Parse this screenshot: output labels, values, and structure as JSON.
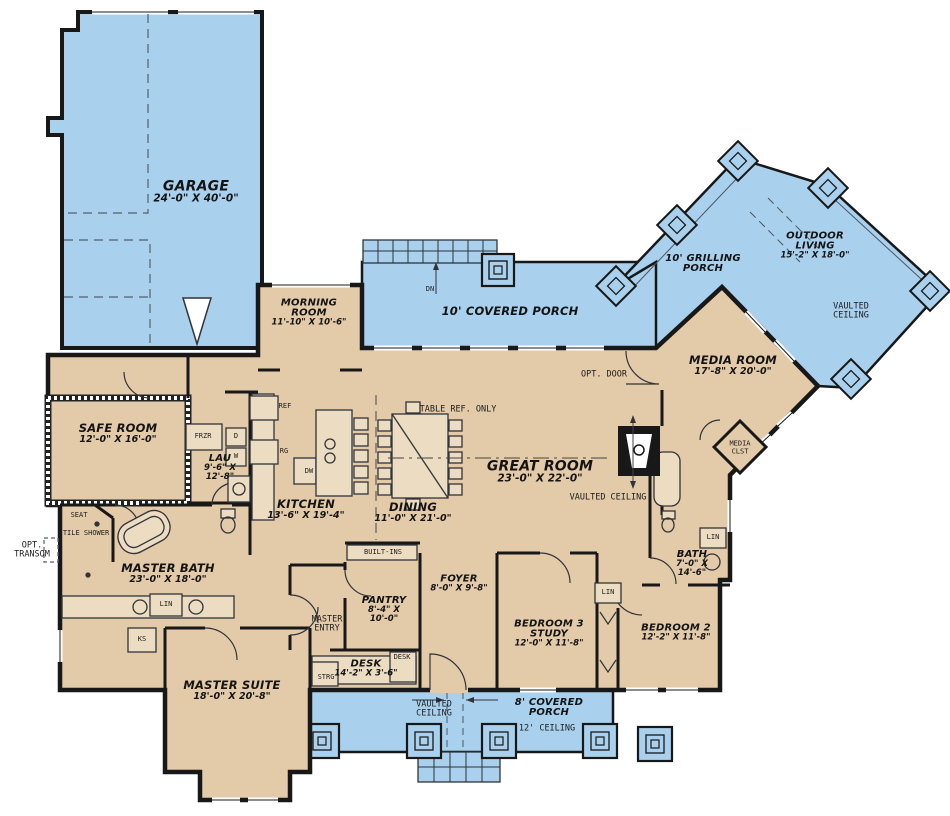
{
  "colors": {
    "porch_blue": "#a9d1ee",
    "interior_tan": "#e3caa9",
    "wall_black": "#181818",
    "thin_line": "#3c3c3c"
  },
  "rooms": {
    "garage": {
      "name": "GARAGE",
      "dims": "24'-0\" X 40'-0\""
    },
    "morning_room": {
      "name": "MORNING ROOM",
      "dims": "11'-10\" X 10'-6\""
    },
    "covered_porch": {
      "name": "10' COVERED PORCH"
    },
    "grilling_porch": {
      "name": "10' GRILLING PORCH"
    },
    "outdoor_living": {
      "name": "OUTDOOR LIVING",
      "dims": "15'-2\" X 18'-0\""
    },
    "media_room": {
      "name": "MEDIA ROOM",
      "dims": "17'-8\" X 20'-0\""
    },
    "safe_room": {
      "name": "SAFE ROOM",
      "dims": "12'-0\" X 16'-0\""
    },
    "laundry": {
      "name": "LAU",
      "dims": "9'-6\" X 12'-8\""
    },
    "kitchen": {
      "name": "KITCHEN",
      "dims": "13'-6\" X 19'-4\""
    },
    "dining": {
      "name": "DINING",
      "dims": "11'-0\" X 21'-0\""
    },
    "great_room": {
      "name": "GREAT ROOM",
      "dims": "23'-0\" X 22'-0\""
    },
    "master_bath": {
      "name": "MASTER BATH",
      "dims": "23'-0\" X 18'-0\""
    },
    "master_suite": {
      "name": "MASTER SUITE",
      "dims": "18'-0\" X 20'-8\""
    },
    "pantry": {
      "name": "PANTRY",
      "dims": "8'-4\" X 10'-0\""
    },
    "foyer": {
      "name": "FOYER",
      "dims": "8'-0\" X 9'-8\""
    },
    "desk": {
      "name": "DESK",
      "dims": "14'-2\" X 3'-6\""
    },
    "bedroom3": {
      "name": "BEDROOM 3 STUDY",
      "dims": "12'-0\" X 11'-8\""
    },
    "bedroom2": {
      "name": "BEDROOM 2",
      "dims": "12'-2\" X 11'-8\""
    },
    "bath2": {
      "name": "BATH",
      "dims": "7'-0\" X 14'-6\""
    },
    "porch8": {
      "name": "8' COVERED PORCH"
    }
  },
  "annotations": {
    "dn": "DN",
    "vaulted_ceiling": "VAULTED CEILING",
    "ceiling12": "12' CEILING",
    "opt_door": "OPT. DOOR",
    "opt_transom": "OPT. TRANSOM",
    "table_ref": "TABLE REF. ONLY",
    "seat": "SEAT",
    "tile_shower": "TILE SHOWER",
    "master_entry": "MASTER ENTRY",
    "built_ins": "BUILT-INS",
    "desk_cab": "DESK",
    "strg": "STRG",
    "media_clst": "MEDIA CLST",
    "lin": "LIN",
    "ks": "KS",
    "frzr": "FRZR",
    "ref": "REF",
    "rg": "RG",
    "dw": "DW",
    "d": "D",
    "w": "W"
  }
}
